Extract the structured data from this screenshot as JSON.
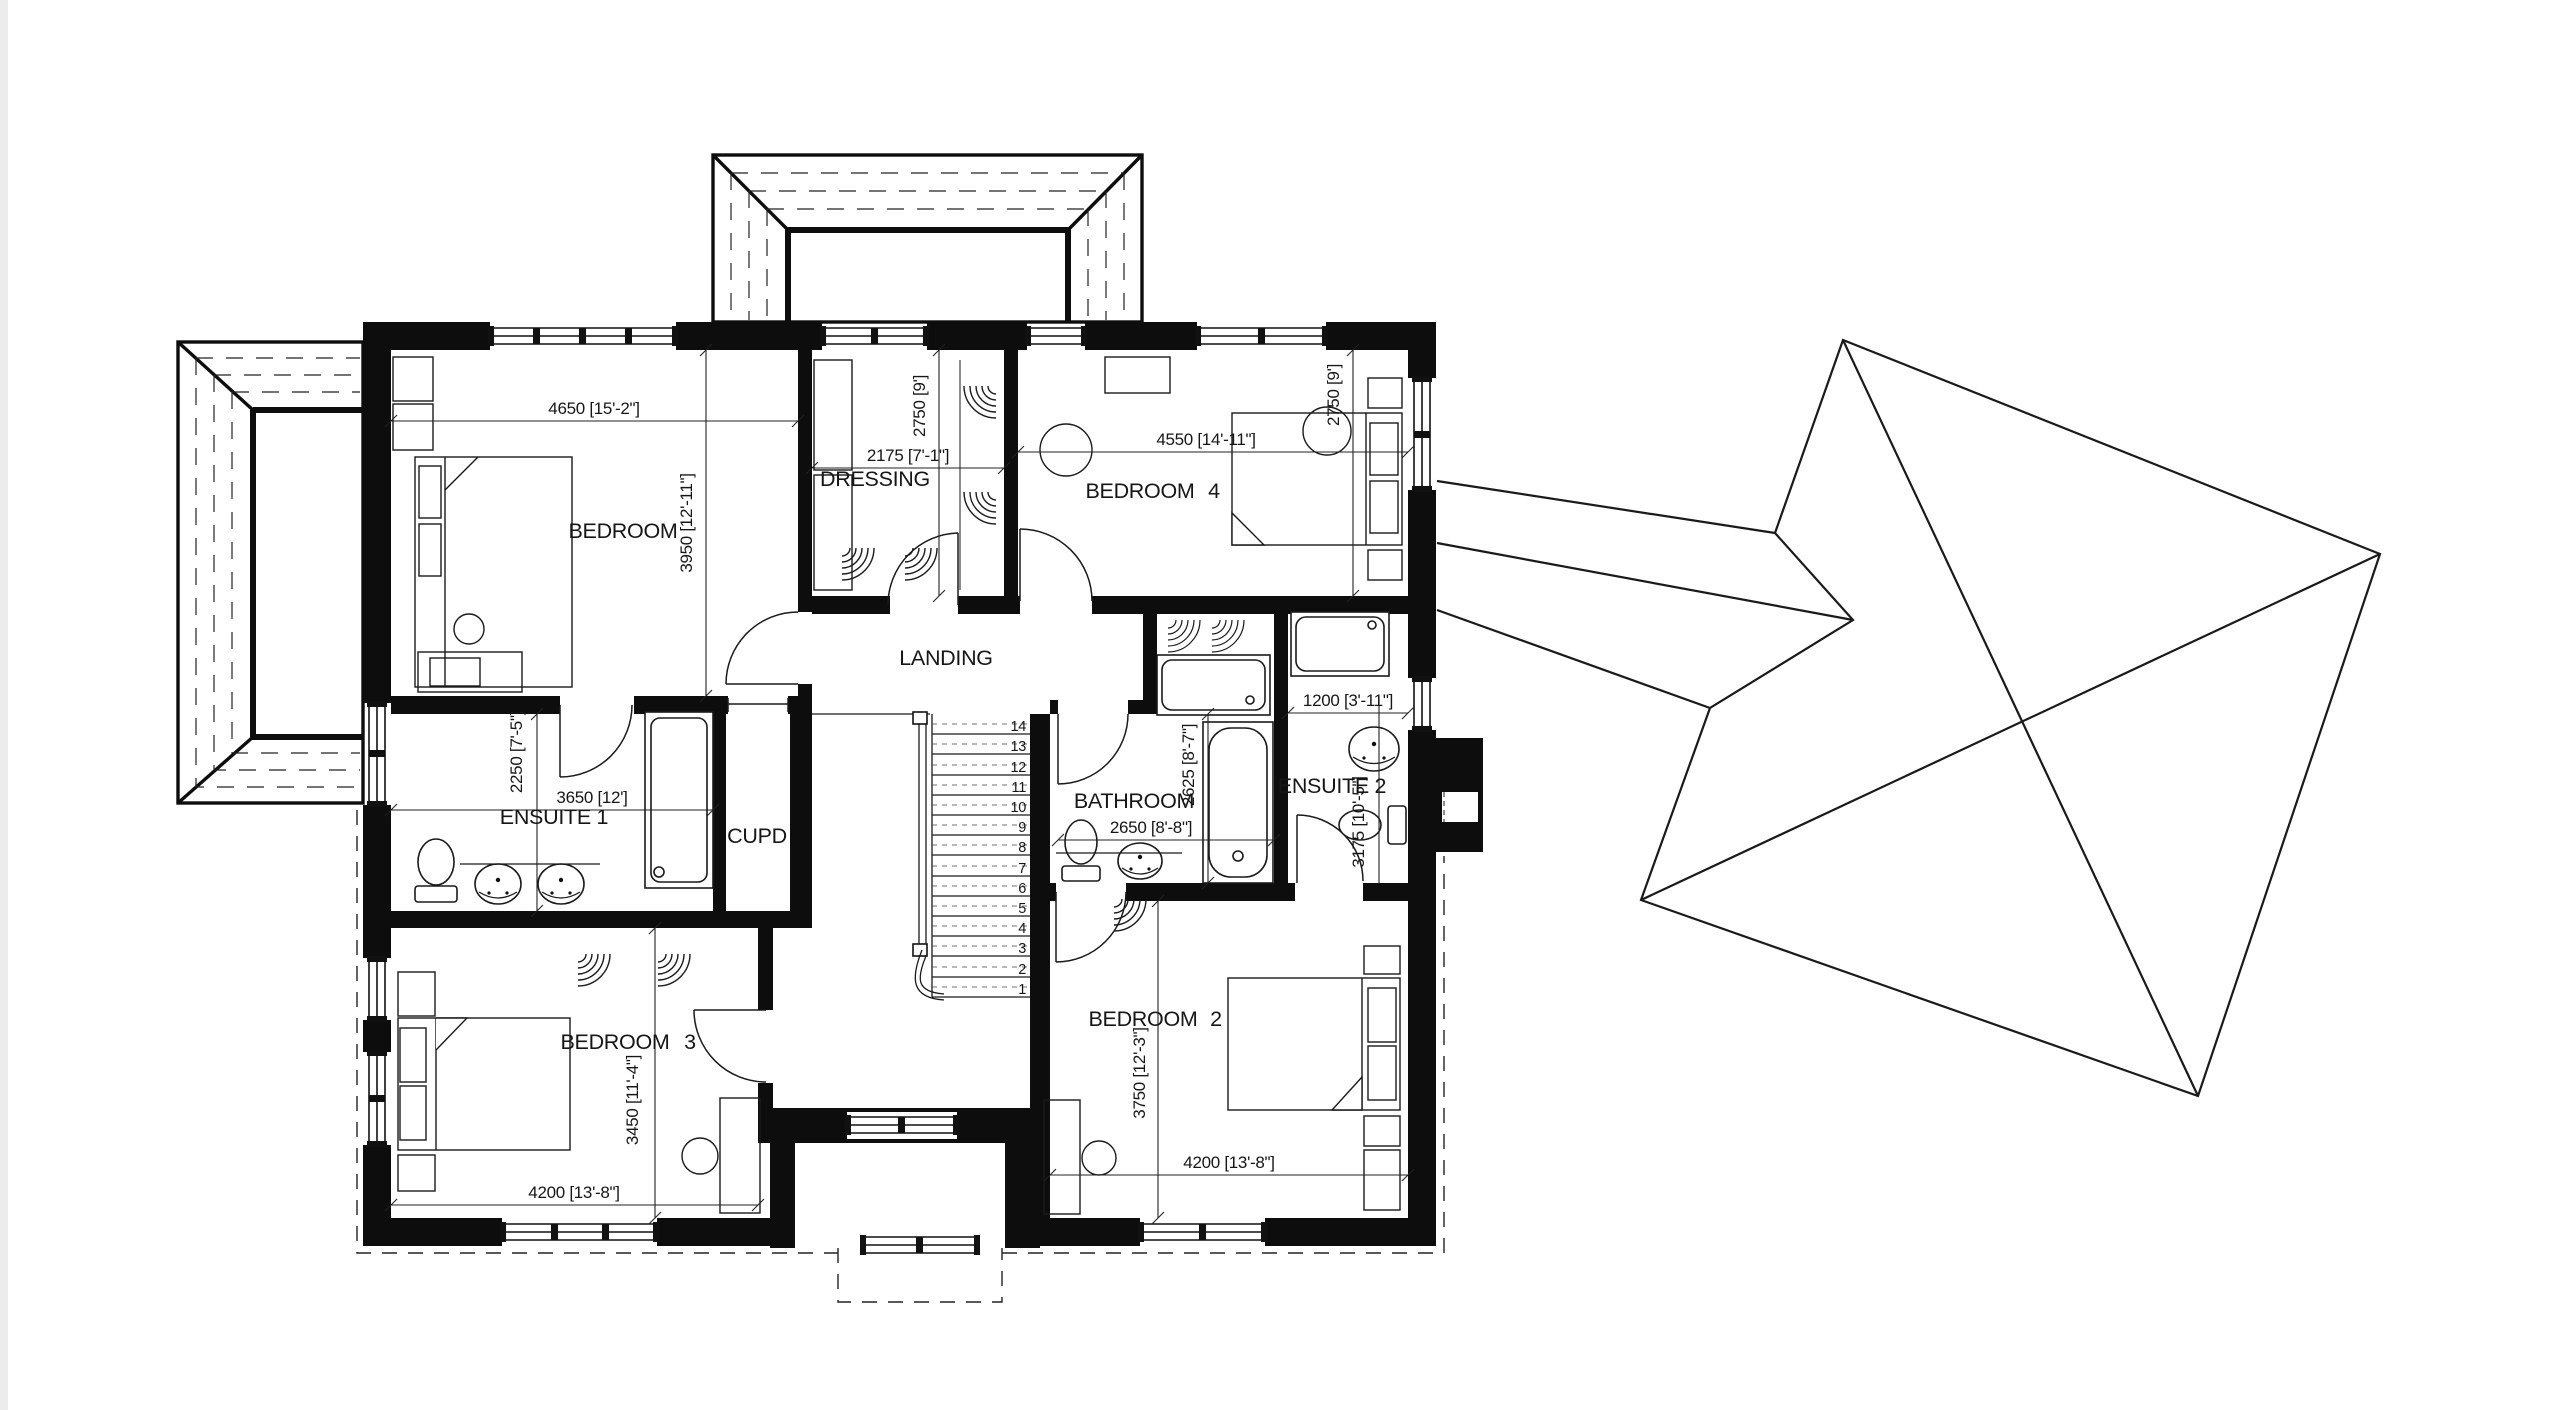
{
  "drawing": {
    "type": "first-floor-plan-with-roof-plan",
    "rooms": {
      "bedroom1": {
        "label": "BEDROOM",
        "number": "",
        "dim_w": "4650 [15'-2\"]",
        "dim_h": "3950 [12'-11\"]"
      },
      "dressing": {
        "label": "DRESSING",
        "dim_w": "2175 [7'-1\"]",
        "dim_h": "2750 [9']"
      },
      "bedroom4": {
        "label": "BEDROOM",
        "number": "4",
        "dim_w": "4550 [14'-11\"]",
        "dim_h": "2750 [9']"
      },
      "landing": {
        "label": "LANDING"
      },
      "ensuite1": {
        "label": "ENSUITE 1",
        "dim_w": "3650 [12']",
        "dim_h": "2250 [7'-5\"]"
      },
      "cupd": {
        "label": "CUPD"
      },
      "bathroom": {
        "label": "BATHROOM",
        "dim_w": "2650 [8'-8\"]",
        "dim_h": "2625 [8'-7\"]"
      },
      "ensuite2": {
        "label": "ENSUITE 2",
        "dim_w": "1200 [3'-11\"]",
        "dim_h": "3175 [10'-5\"]"
      },
      "bedroom3": {
        "label": "BEDROOM",
        "number": "3",
        "dim_w": "4200 [13'-8\"]",
        "dim_h": "3450 [11'-4\"]"
      },
      "bedroom2": {
        "label": "BEDROOM",
        "number": "2",
        "dim_w": "4200 [13'-8\"]",
        "dim_h": "3750 [12'-3\"]"
      }
    },
    "stairs": {
      "treads": [
        "14",
        "13",
        "12",
        "11",
        "10",
        "9",
        "8",
        "7",
        "6",
        "5",
        "4",
        "3",
        "2",
        "1"
      ]
    },
    "colors": {
      "wall": "#0d0d0d",
      "line": "#1a1a1a",
      "background": "#ffffff"
    }
  }
}
